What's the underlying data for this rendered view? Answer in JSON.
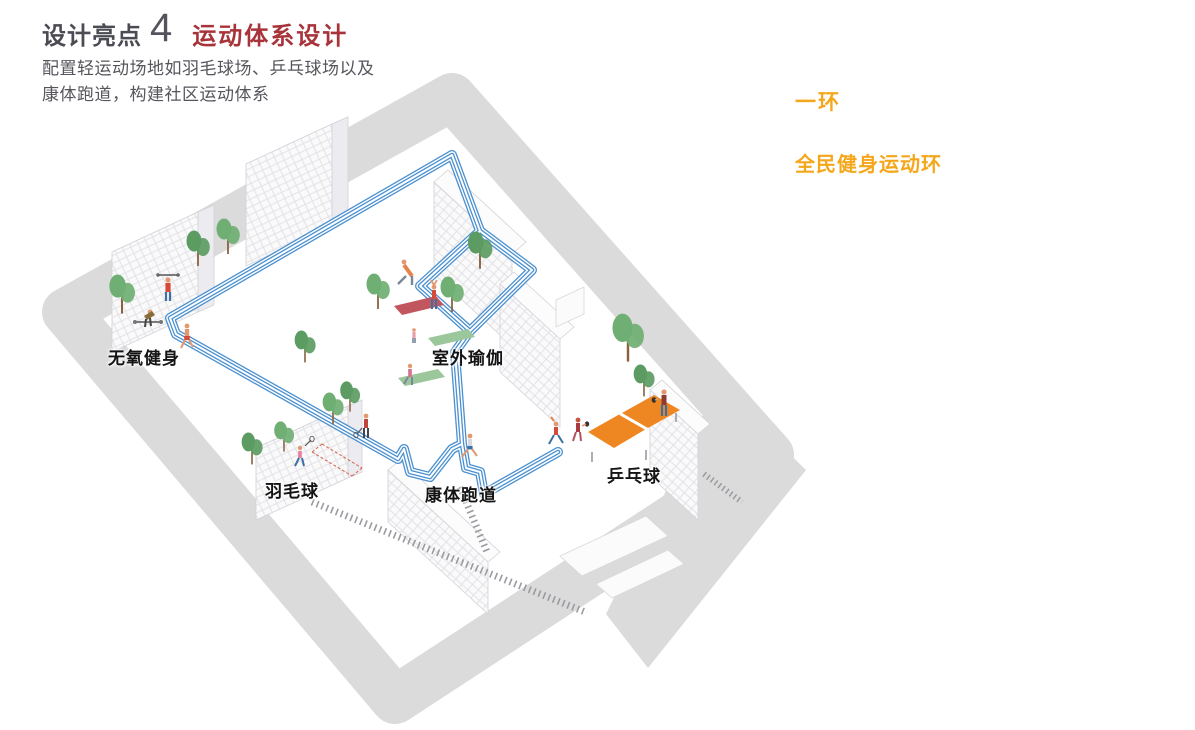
{
  "header": {
    "highlight_label": "设计亮点",
    "highlight_number": "4",
    "title": "运动体系设计",
    "description_line1": "配置轻运动场地如羽毛球场、乒乓球场以及",
    "description_line2": "康体跑道，构建社区运动体系"
  },
  "legend": {
    "ring_label": "一环",
    "ring_title": "全民健身运动环"
  },
  "map": {
    "labels": [
      {
        "id": "anaerobic",
        "text": "无氧健身"
      },
      {
        "id": "yoga",
        "text": "室外瑜伽"
      },
      {
        "id": "badminton",
        "text": "羽毛球"
      },
      {
        "id": "track",
        "text": "康体跑道"
      },
      {
        "id": "pingpong",
        "text": "乒乓球"
      }
    ]
  },
  "colors": {
    "title_red": "#a8343b",
    "accent_orange": "#f5a71b",
    "track_blue": "#4a90d0",
    "road_gray": "#dbdbdb",
    "tree_green": "#6faf73",
    "tree_green_dark": "#5c9c62",
    "table_orange": "#ee8722",
    "text_dark": "#4b4b53"
  }
}
